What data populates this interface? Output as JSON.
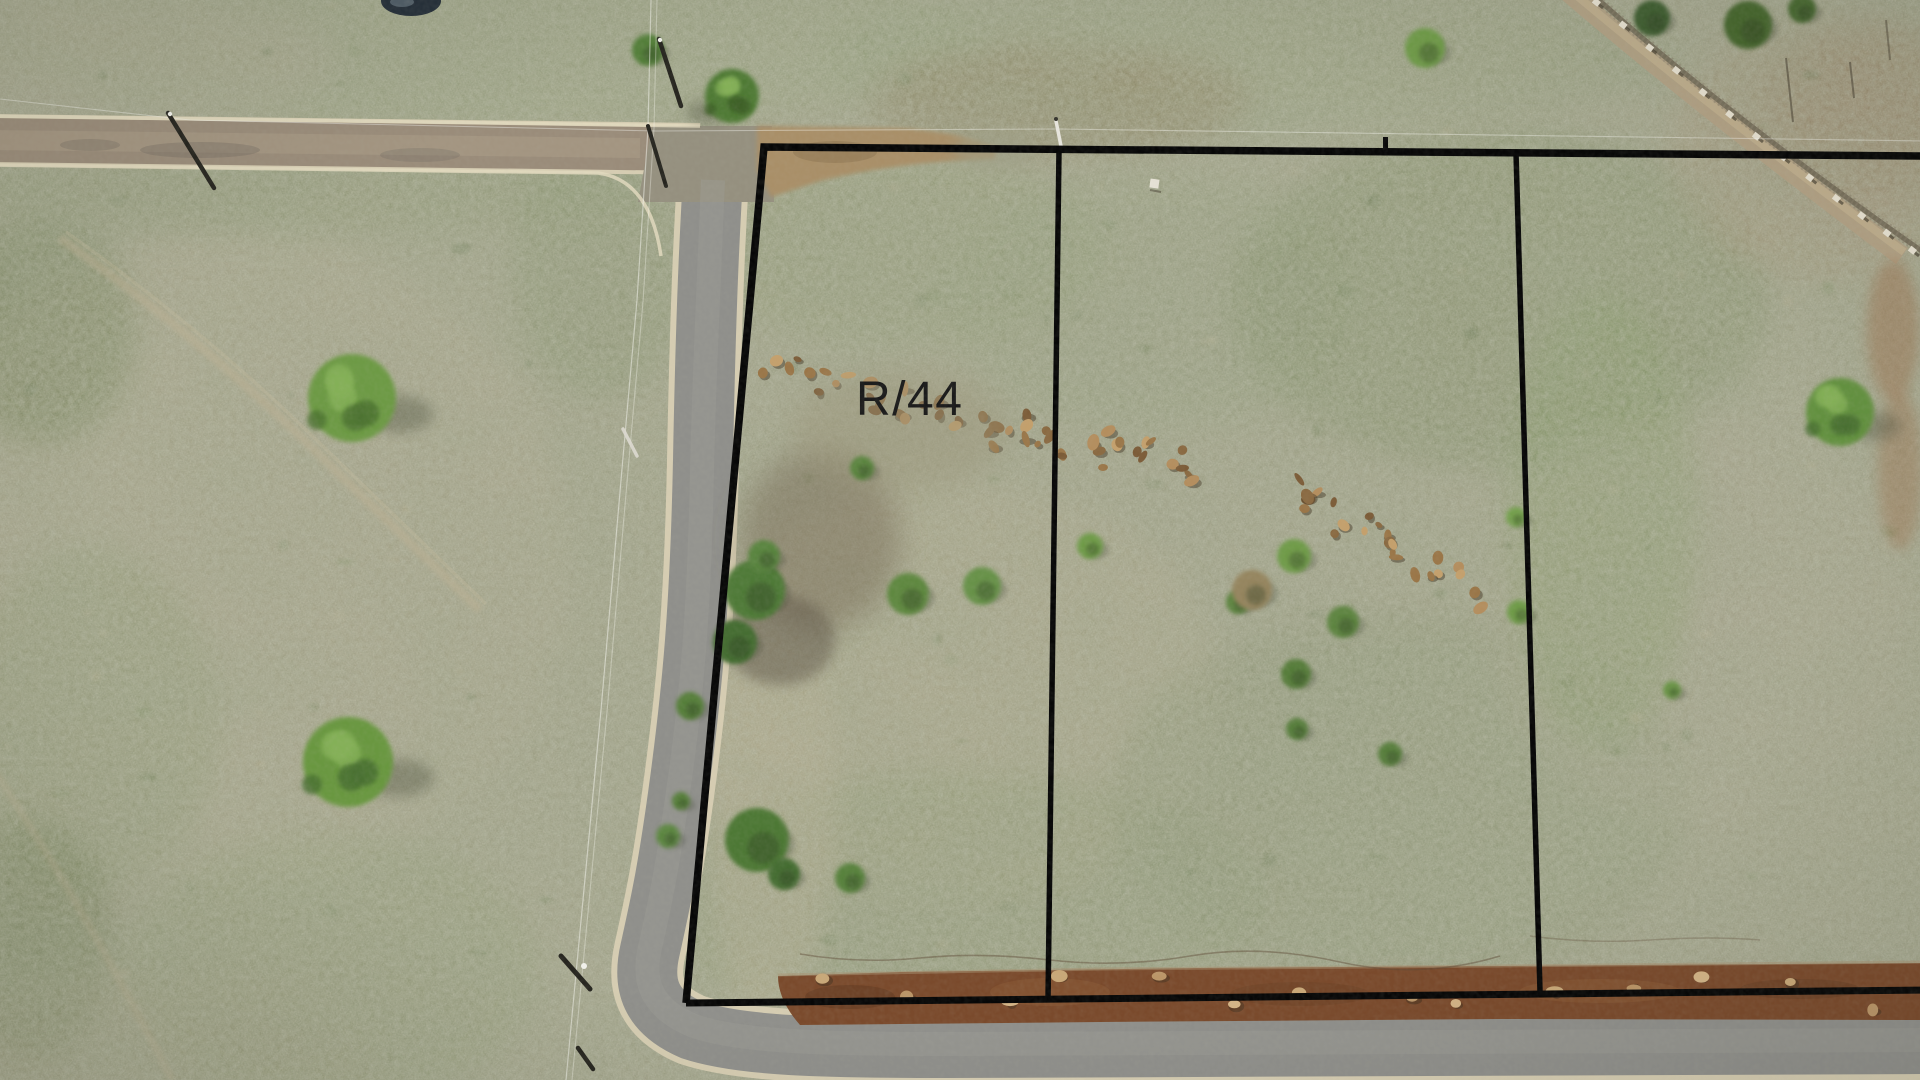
{
  "scene": {
    "plot_label": "R/44",
    "colors": {
      "boundary_line": "#070707",
      "label_text": "#1a1a1a",
      "grass_base": "#9e9f86",
      "road_asphalt": "#8f8f8b",
      "road_gravel": "#9a8c7a",
      "road_shoulder": "#d6cdb2",
      "graded_dirt_strip": "#7a4a2c",
      "dirt_track": "#a98f68",
      "tree_green": "#699741",
      "pond_water": "#26303a"
    },
    "landscape_features": [
      "grass-field",
      "gravel-road",
      "asphalt-road",
      "road-junction",
      "dirt-track-stub",
      "graded-dirt-strip",
      "plot-boundary-overlay",
      "plot-divider-lines",
      "plot-label",
      "trees",
      "shrubs",
      "rock-scatter",
      "utility-poles",
      "power-lines",
      "boundary-fence",
      "pond",
      "foot-trail"
    ]
  }
}
